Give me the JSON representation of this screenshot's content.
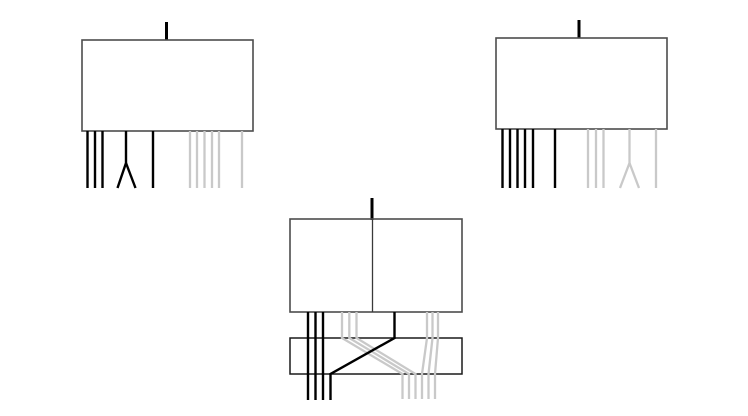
{
  "canvas": {
    "width": 748,
    "height": 416,
    "background": "#ffffff"
  },
  "palette": {
    "box_border": "#4d4d4d",
    "band_border": "#1a1a1a",
    "divider": "#3a3a3a",
    "black_fiber": "#000000",
    "gray_fiber": "#c9c9c9"
  },
  "stroke_widths": {
    "box": 1.6,
    "band": 1.5,
    "divider": 1.3,
    "stem": 3,
    "fiber": 2.4,
    "gray_fiber": 2.3
  },
  "figures": [
    {
      "name": "top-left-module",
      "shapes": [
        {
          "name": "top-left-stem",
          "type": "polyline",
          "stroke": "black_fiber",
          "width": 3,
          "points": [
            [
              166.5,
              22
            ],
            [
              166.5,
              40
            ]
          ]
        },
        {
          "name": "top-left-box",
          "type": "rect",
          "stroke": "box_border",
          "width": 1.6,
          "x": 82,
          "y": 40,
          "w": 171,
          "h": 91
        },
        {
          "name": "top-left-gray-fiber-1",
          "type": "polyline",
          "stroke": "gray_fiber",
          "width": 2.3,
          "points": [
            [
              190,
              131
            ],
            [
              190,
              188
            ]
          ]
        },
        {
          "name": "top-left-gray-fiber-2",
          "type": "polyline",
          "stroke": "gray_fiber",
          "width": 2.3,
          "points": [
            [
              197,
              131
            ],
            [
              197,
              188
            ]
          ]
        },
        {
          "name": "top-left-gray-fiber-3",
          "type": "polyline",
          "stroke": "gray_fiber",
          "width": 2.3,
          "points": [
            [
              204.5,
              131
            ],
            [
              204.5,
              188
            ]
          ]
        },
        {
          "name": "top-left-gray-fiber-4",
          "type": "polyline",
          "stroke": "gray_fiber",
          "width": 2.3,
          "points": [
            [
              212,
              131
            ],
            [
              212,
              188
            ]
          ]
        },
        {
          "name": "top-left-gray-fiber-5",
          "type": "polyline",
          "stroke": "gray_fiber",
          "width": 2.3,
          "points": [
            [
              219,
              131
            ],
            [
              219,
              188
            ]
          ]
        },
        {
          "name": "top-left-gray-fiber-lone",
          "type": "polyline",
          "stroke": "gray_fiber",
          "width": 2.3,
          "points": [
            [
              242,
              131
            ],
            [
              242,
              188
            ]
          ]
        },
        {
          "name": "top-left-black-fiber-1",
          "type": "polyline",
          "stroke": "black_fiber",
          "width": 2.4,
          "points": [
            [
              87.5,
              131
            ],
            [
              87.5,
              188
            ]
          ]
        },
        {
          "name": "top-left-black-fiber-2",
          "type": "polyline",
          "stroke": "black_fiber",
          "width": 2.4,
          "points": [
            [
              95,
              131
            ],
            [
              95,
              188
            ]
          ]
        },
        {
          "name": "top-left-black-fiber-3",
          "type": "polyline",
          "stroke": "black_fiber",
          "width": 2.4,
          "points": [
            [
              102.5,
              131
            ],
            [
              102.5,
              188
            ]
          ]
        },
        {
          "name": "top-left-fork-stem-leg",
          "type": "polyline",
          "stroke": "black_fiber",
          "width": 2.4,
          "points": [
            [
              126,
              131
            ],
            [
              126,
              163
            ],
            [
              117.5,
              188
            ]
          ]
        },
        {
          "name": "top-left-fork-branch-leg",
          "type": "polyline",
          "stroke": "black_fiber",
          "width": 2.4,
          "points": [
            [
              126,
              163
            ],
            [
              135.5,
              188
            ]
          ]
        },
        {
          "name": "top-left-black-fiber-lone",
          "type": "polyline",
          "stroke": "black_fiber",
          "width": 2.4,
          "points": [
            [
              153,
              131
            ],
            [
              153,
              188
            ]
          ]
        }
      ]
    },
    {
      "name": "top-right-module",
      "shapes": [
        {
          "name": "top-right-stem",
          "type": "polyline",
          "stroke": "black_fiber",
          "width": 3,
          "points": [
            [
              579,
              20
            ],
            [
              579,
              38
            ]
          ]
        },
        {
          "name": "top-right-box",
          "type": "rect",
          "stroke": "box_border",
          "width": 1.6,
          "x": 496,
          "y": 38,
          "w": 171,
          "h": 91
        },
        {
          "name": "top-right-gray-fiber-1",
          "type": "polyline",
          "stroke": "gray_fiber",
          "width": 2.3,
          "points": [
            [
              588,
              129
            ],
            [
              588,
              188
            ]
          ]
        },
        {
          "name": "top-right-gray-fiber-2",
          "type": "polyline",
          "stroke": "gray_fiber",
          "width": 2.3,
          "points": [
            [
              596,
              129
            ],
            [
              596,
              188
            ]
          ]
        },
        {
          "name": "top-right-gray-fiber-3",
          "type": "polyline",
          "stroke": "gray_fiber",
          "width": 2.3,
          "points": [
            [
              603.5,
              129
            ],
            [
              603.5,
              188
            ]
          ]
        },
        {
          "name": "top-right-gray-fork-stem-leg",
          "type": "polyline",
          "stroke": "gray_fiber",
          "width": 2.3,
          "points": [
            [
              629.5,
              129
            ],
            [
              629.5,
              163
            ],
            [
              620,
              188
            ]
          ]
        },
        {
          "name": "top-right-gray-fork-branch-leg",
          "type": "polyline",
          "stroke": "gray_fiber",
          "width": 2.3,
          "points": [
            [
              629.5,
              163
            ],
            [
              639,
              188
            ]
          ]
        },
        {
          "name": "top-right-gray-fiber-lone",
          "type": "polyline",
          "stroke": "gray_fiber",
          "width": 2.3,
          "points": [
            [
              656,
              129
            ],
            [
              656,
              188
            ]
          ]
        },
        {
          "name": "top-right-black-fiber-1",
          "type": "polyline",
          "stroke": "black_fiber",
          "width": 2.4,
          "points": [
            [
              502.5,
              129
            ],
            [
              502.5,
              188
            ]
          ]
        },
        {
          "name": "top-right-black-fiber-2",
          "type": "polyline",
          "stroke": "black_fiber",
          "width": 2.4,
          "points": [
            [
              510,
              129
            ],
            [
              510,
              188
            ]
          ]
        },
        {
          "name": "top-right-black-fiber-3",
          "type": "polyline",
          "stroke": "black_fiber",
          "width": 2.4,
          "points": [
            [
              517.5,
              129
            ],
            [
              517.5,
              188
            ]
          ]
        },
        {
          "name": "top-right-black-fiber-4",
          "type": "polyline",
          "stroke": "black_fiber",
          "width": 2.4,
          "points": [
            [
              525,
              129
            ],
            [
              525,
              188
            ]
          ]
        },
        {
          "name": "top-right-black-fiber-5",
          "type": "polyline",
          "stroke": "black_fiber",
          "width": 2.4,
          "points": [
            [
              533,
              129
            ],
            [
              533,
              188
            ]
          ]
        },
        {
          "name": "top-right-black-fiber-lone",
          "type": "polyline",
          "stroke": "black_fiber",
          "width": 2.4,
          "points": [
            [
              555,
              129
            ],
            [
              555,
              188
            ]
          ]
        }
      ]
    },
    {
      "name": "bottom-merge-module",
      "shapes": [
        {
          "name": "bottom-stem",
          "type": "polyline",
          "stroke": "black_fiber",
          "width": 3,
          "points": [
            [
              372,
              198
            ],
            [
              372,
              220
            ]
          ]
        },
        {
          "name": "bottom-box",
          "type": "rect",
          "stroke": "box_border",
          "width": 1.6,
          "x": 290,
          "y": 219,
          "w": 172,
          "h": 93
        },
        {
          "name": "bottom-box-divider",
          "type": "polyline",
          "stroke": "divider",
          "width": 1.3,
          "points": [
            [
              372.5,
              219
            ],
            [
              372.5,
              312
            ]
          ]
        },
        {
          "name": "crossover-band",
          "type": "rect",
          "stroke": "band_border",
          "width": 1.5,
          "x": 290,
          "y": 338,
          "w": 172,
          "h": 36
        },
        {
          "name": "bottom-gray-left-fiber-1",
          "type": "polyline",
          "stroke": "gray_fiber",
          "width": 2.3,
          "points": [
            [
              342,
              312
            ],
            [
              342,
              338
            ],
            [
              402.5,
              374
            ],
            [
              402.5,
              399
            ]
          ]
        },
        {
          "name": "bottom-gray-left-fiber-2",
          "type": "polyline",
          "stroke": "gray_fiber",
          "width": 2.3,
          "points": [
            [
              349.3,
              312
            ],
            [
              349.3,
              338
            ],
            [
              409,
              374
            ],
            [
              409,
              399
            ]
          ]
        },
        {
          "name": "bottom-gray-left-fiber-3",
          "type": "polyline",
          "stroke": "gray_fiber",
          "width": 2.3,
          "points": [
            [
              356.5,
              312
            ],
            [
              356.5,
              338
            ],
            [
              415.5,
              374
            ],
            [
              415.5,
              399
            ]
          ]
        },
        {
          "name": "bottom-gray-right-fiber-1",
          "type": "polyline",
          "stroke": "gray_fiber",
          "width": 2.3,
          "points": [
            [
              427,
              312
            ],
            [
              427,
              338
            ],
            [
              422,
              374
            ],
            [
              422,
              399
            ]
          ]
        },
        {
          "name": "bottom-gray-right-fiber-2",
          "type": "polyline",
          "stroke": "gray_fiber",
          "width": 2.3,
          "points": [
            [
              432.5,
              312
            ],
            [
              432.5,
              338
            ],
            [
              428.5,
              374
            ],
            [
              428.5,
              399
            ]
          ]
        },
        {
          "name": "bottom-gray-right-fiber-3",
          "type": "polyline",
          "stroke": "gray_fiber",
          "width": 2.3,
          "points": [
            [
              438,
              312
            ],
            [
              438,
              338
            ],
            [
              435,
              374
            ],
            [
              435,
              399
            ]
          ]
        },
        {
          "name": "bottom-black-fiber-1",
          "type": "polyline",
          "stroke": "black_fiber",
          "width": 2.4,
          "points": [
            [
              308,
              312
            ],
            [
              308,
              400
            ]
          ]
        },
        {
          "name": "bottom-black-fiber-2",
          "type": "polyline",
          "stroke": "black_fiber",
          "width": 2.4,
          "points": [
            [
              315.5,
              312
            ],
            [
              315.5,
              400
            ]
          ]
        },
        {
          "name": "bottom-black-fiber-3",
          "type": "polyline",
          "stroke": "black_fiber",
          "width": 2.4,
          "points": [
            [
              323,
              312
            ],
            [
              323,
              400
            ]
          ]
        },
        {
          "name": "bottom-black-crossing-fiber",
          "type": "polyline",
          "stroke": "black_fiber",
          "width": 2.4,
          "points": [
            [
              394.5,
              312
            ],
            [
              394.5,
              338
            ],
            [
              330.5,
              374
            ],
            [
              330.5,
              400
            ]
          ]
        }
      ]
    }
  ]
}
